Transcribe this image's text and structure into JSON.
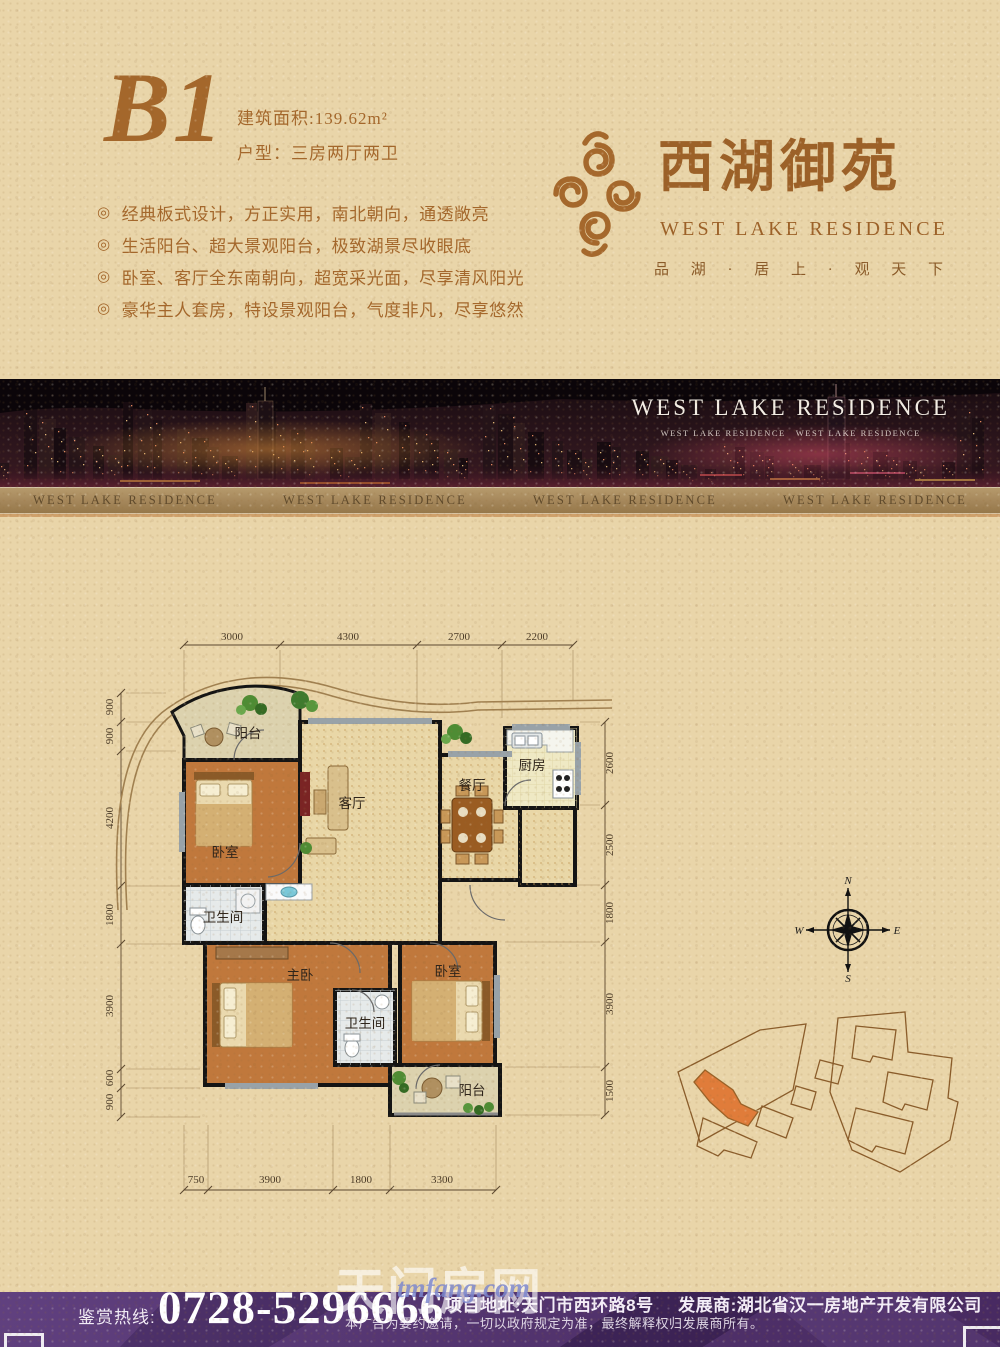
{
  "header": {
    "unit": "B1",
    "area": "建筑面积:139.62m²",
    "layout": "户型：三房两厅两卫",
    "bullet": "◎",
    "features": [
      "经典板式设计，方正实用，南北朝向，通透敞亮",
      "生活阳台、超大景观阳台，极致湖景尽收眼底",
      "卧室、客厅全东南朝向，超宽采光面，尽享清风阳光",
      "豪华主人套房，特设景观阳台，气度非凡，尽享悠然"
    ]
  },
  "brand": {
    "cn": "西湖御苑",
    "en": "WEST LAKE RESIDENCE",
    "tagline": "品 湖 · 居 上 · 观 天 下",
    "color": "#a5682c"
  },
  "banner": {
    "title": "WEST LAKE RESIDENCE",
    "subtitle": "WEST LAKE RESIDENCE　WEST LAKE RESIDENCE",
    "strip": [
      "WEST LAKE RESIDENCE",
      "WEST LAKE RESIDENCE",
      "WEST LAKE RESIDENCE",
      "WEST LAKE RESIDENCE"
    ]
  },
  "floorplan": {
    "dims_top": [
      "3000",
      "4300",
      "2700",
      "2200"
    ],
    "dims_left": [
      "900",
      "900",
      "4200",
      "1800",
      "3900",
      "600",
      "900"
    ],
    "dims_right": [
      "2600",
      "2500",
      "1800",
      "3900",
      "1500"
    ],
    "dims_bottom": [
      "750",
      "3900",
      "1800",
      "3300"
    ],
    "rooms": {
      "balcony_top": "阳台",
      "bedroom1": "卧室",
      "living": "客厅",
      "dining": "餐厅",
      "kitchen": "厨房",
      "bath1": "卫生间",
      "master": "主卧",
      "bath2": "卫生间",
      "bedroom2": "卧室",
      "balcony_bottom": "阳台"
    },
    "compass": {
      "n": "N",
      "e": "E",
      "s": "S",
      "w": "W"
    }
  },
  "footer": {
    "hotline_label": "鉴赏热线:",
    "phone": "0728-5296666",
    "address": "项目地址:天门市西环路8号",
    "developer": "发展商:湖北省汉一房地产开发有限公司",
    "disclaimer": "本广告为要约邀请，一切以政府规定为准，最终解释权归发展商所有。"
  },
  "watermark": {
    "cn": "天门房网",
    "en": "tmfang.com"
  }
}
